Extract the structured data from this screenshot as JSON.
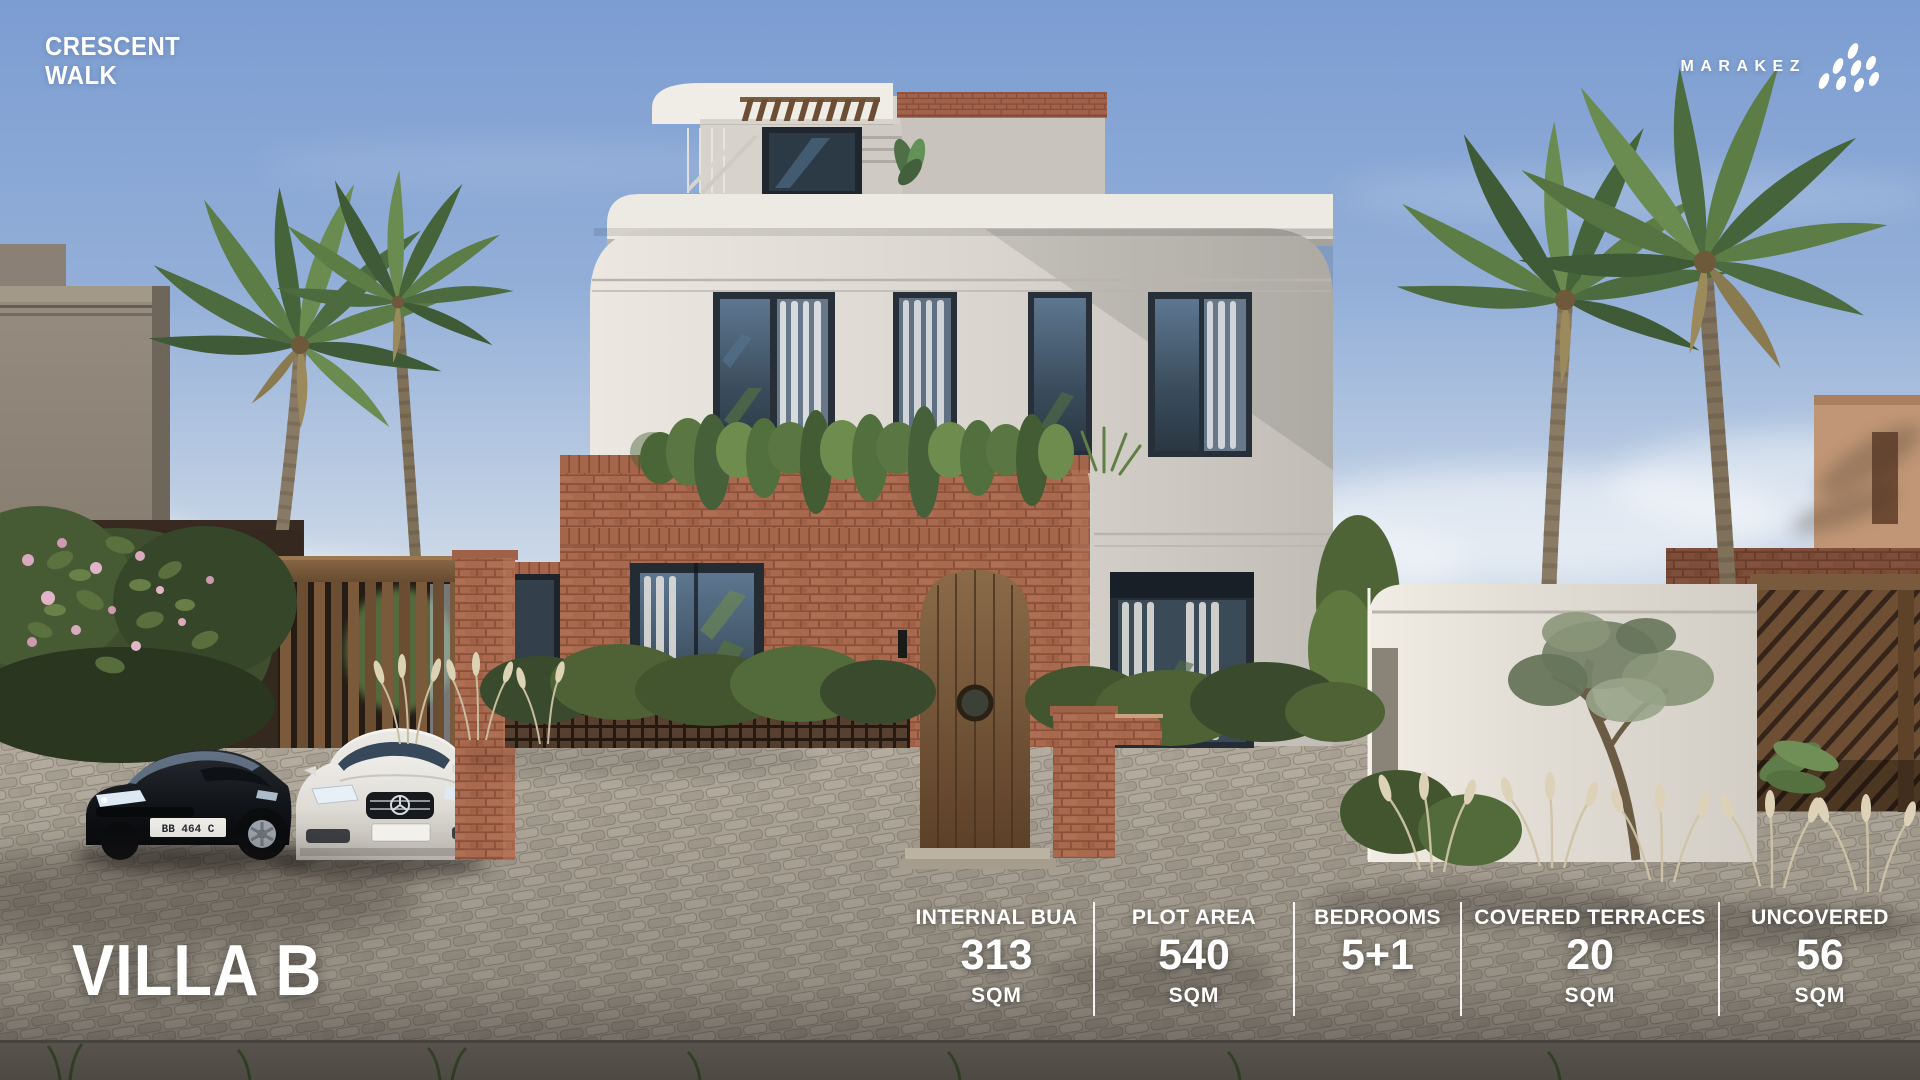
{
  "project": {
    "line1": "CRESCENT",
    "line2": "WALK"
  },
  "brand": {
    "name": "MARAKEZ",
    "logo_icon": "marakez-diamonds"
  },
  "unit": {
    "title": "VILLA B"
  },
  "stats": {
    "divider_color": "#ffffff",
    "items": [
      {
        "label": "INTERNAL BUA",
        "value": "313",
        "unit": "SQM",
        "width": 193
      },
      {
        "label": "PLOT AREA",
        "value": "540",
        "unit": "SQM",
        "width": 200
      },
      {
        "label": "BEDROOMS",
        "value": "5+1",
        "unit": "",
        "width": 167
      },
      {
        "label": "COVERED TERRACES",
        "value": "20",
        "unit": "SQM",
        "width": 258
      },
      {
        "label": "UNCOVERED",
        "value": "56",
        "unit": "SQM",
        "width": 202
      }
    ]
  },
  "scene": {
    "license_plate": "BB 464 C",
    "colors": {
      "sky_top": "#7C9DD2",
      "villa_wall": "#DAD6CF",
      "brick": "#A8694E",
      "road": "#9A9386",
      "overlay_text": "#FFFFFF"
    }
  }
}
